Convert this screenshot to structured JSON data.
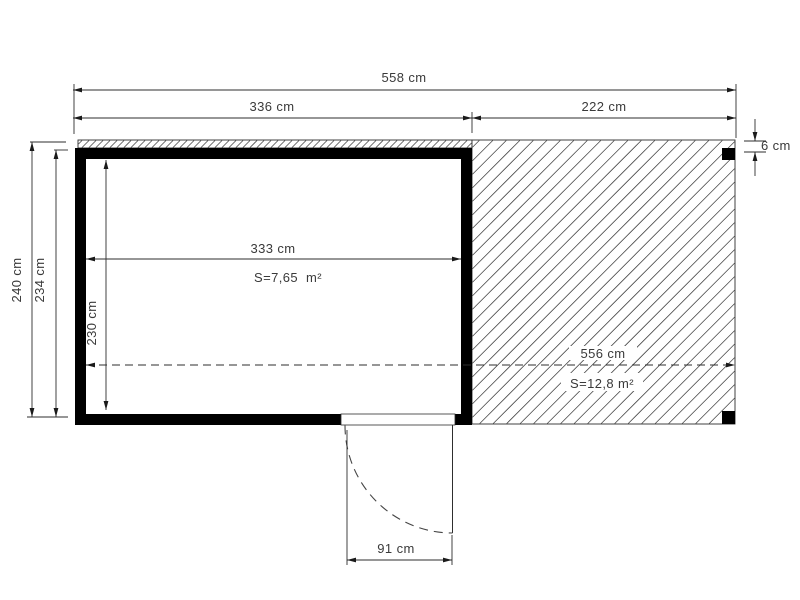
{
  "plan": {
    "title": "garden house floor plan with terrace",
    "colors": {
      "wall": "#000000",
      "line": "#2e2e2e",
      "text": "#3a3a3a",
      "background": "#ffffff"
    },
    "dimensions": {
      "overall_width": "558 cm",
      "cabin_outer_width": "336 cm",
      "terrace_width": "222 cm",
      "edge_thickness": "6 cm",
      "overall_depth": "240 cm",
      "inner_depth": "234 cm",
      "cabin_inner_depth": "230 cm",
      "cabin_inner_width": "333 cm",
      "cabin_area": "S=7,65  m²",
      "terrace_length": "556 cm",
      "terrace_area": "S=12,8 m²",
      "door_width": "91 cm"
    }
  }
}
